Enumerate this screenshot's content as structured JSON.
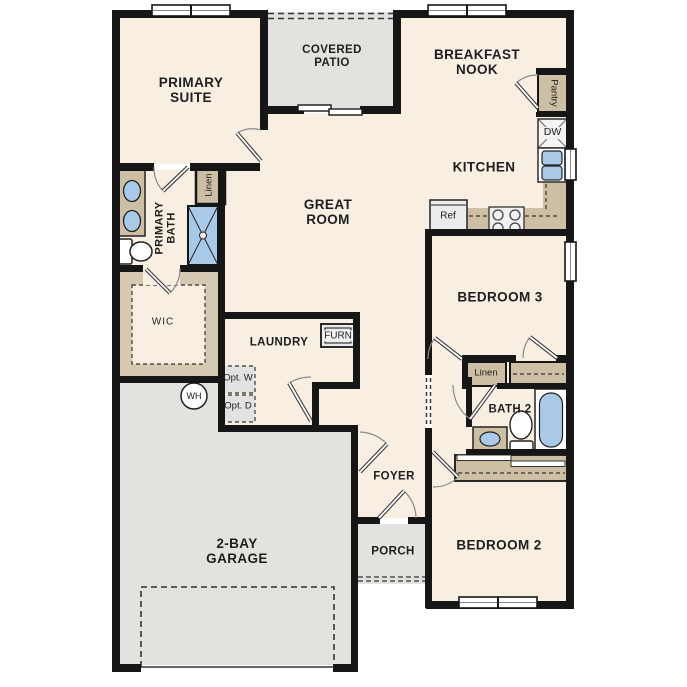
{
  "rooms": {
    "primary_suite": {
      "label": "PRIMARY SUITE"
    },
    "covered_patio": {
      "label": "COVERED PATIO"
    },
    "breakfast_nook": {
      "label": "BREAKFAST NOOK"
    },
    "kitchen": {
      "label": "KITCHEN"
    },
    "great_room": {
      "label": "GREAT ROOM"
    },
    "primary_bath": {
      "label": "PRIMARY BATH"
    },
    "wic": {
      "label": "WIC"
    },
    "laundry": {
      "label": "LAUNDRY"
    },
    "foyer": {
      "label": "FOYER"
    },
    "porch": {
      "label": "PORCH"
    },
    "garage": {
      "label": "2-BAY GARAGE"
    },
    "bedroom_2": {
      "label": "BEDROOM 2"
    },
    "bedroom_3": {
      "label": "BEDROOM 3"
    },
    "bath_2": {
      "label": "BATH 2"
    }
  },
  "closets": {
    "linen_primary": "Linen",
    "linen_hall": "Linen",
    "pantry": "Pantry"
  },
  "appliances": {
    "dishwasher": "DW",
    "refrigerator": "Ref",
    "furnace": "FURN",
    "water_heater": "WH",
    "opt_washer": "Opt. W",
    "opt_dryer": "Opt. D"
  },
  "colors": {
    "floor_beige": "#f8efe2",
    "concrete_gray": "#e3e2df",
    "casework_tan": "#ccbfa3",
    "plumbing_blue": "#a9c9e9",
    "wall_black": "#161616"
  }
}
